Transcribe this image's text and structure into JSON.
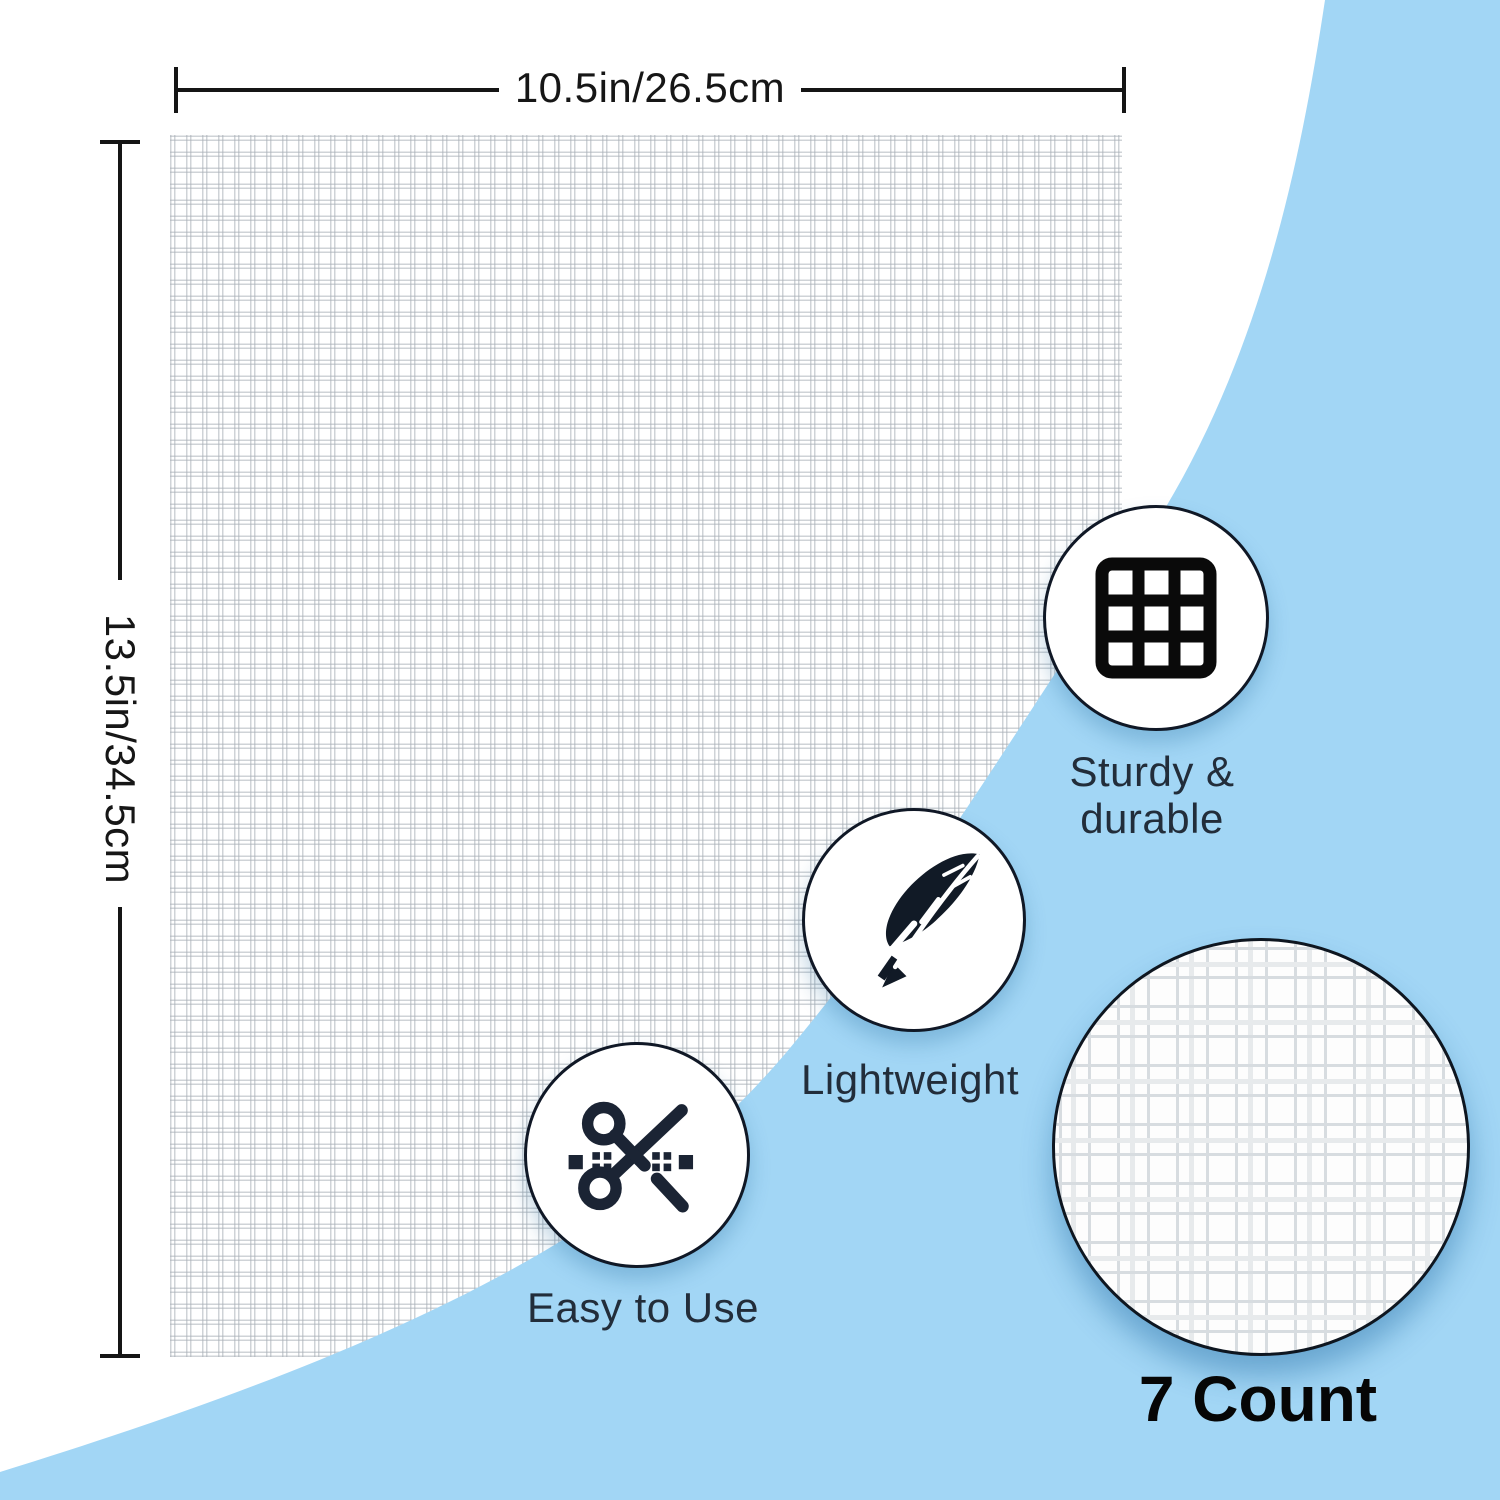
{
  "product": {
    "width_label": "10.5in/26.5cm",
    "height_label": "13.5in/34.5cm",
    "count_label": "7 Count"
  },
  "features": [
    {
      "icon": "grid-icon",
      "line1": "Sturdy &",
      "line2": "durable"
    },
    {
      "icon": "feather-icon",
      "line1": "Lightweight"
    },
    {
      "icon": "scissors-icon",
      "line1": "Easy to Use"
    }
  ],
  "colors": {
    "accent_blue": "#a2d6f5",
    "icon_navy": "#1b2434",
    "label_navy": "#222d3a",
    "line_black": "#151515"
  }
}
